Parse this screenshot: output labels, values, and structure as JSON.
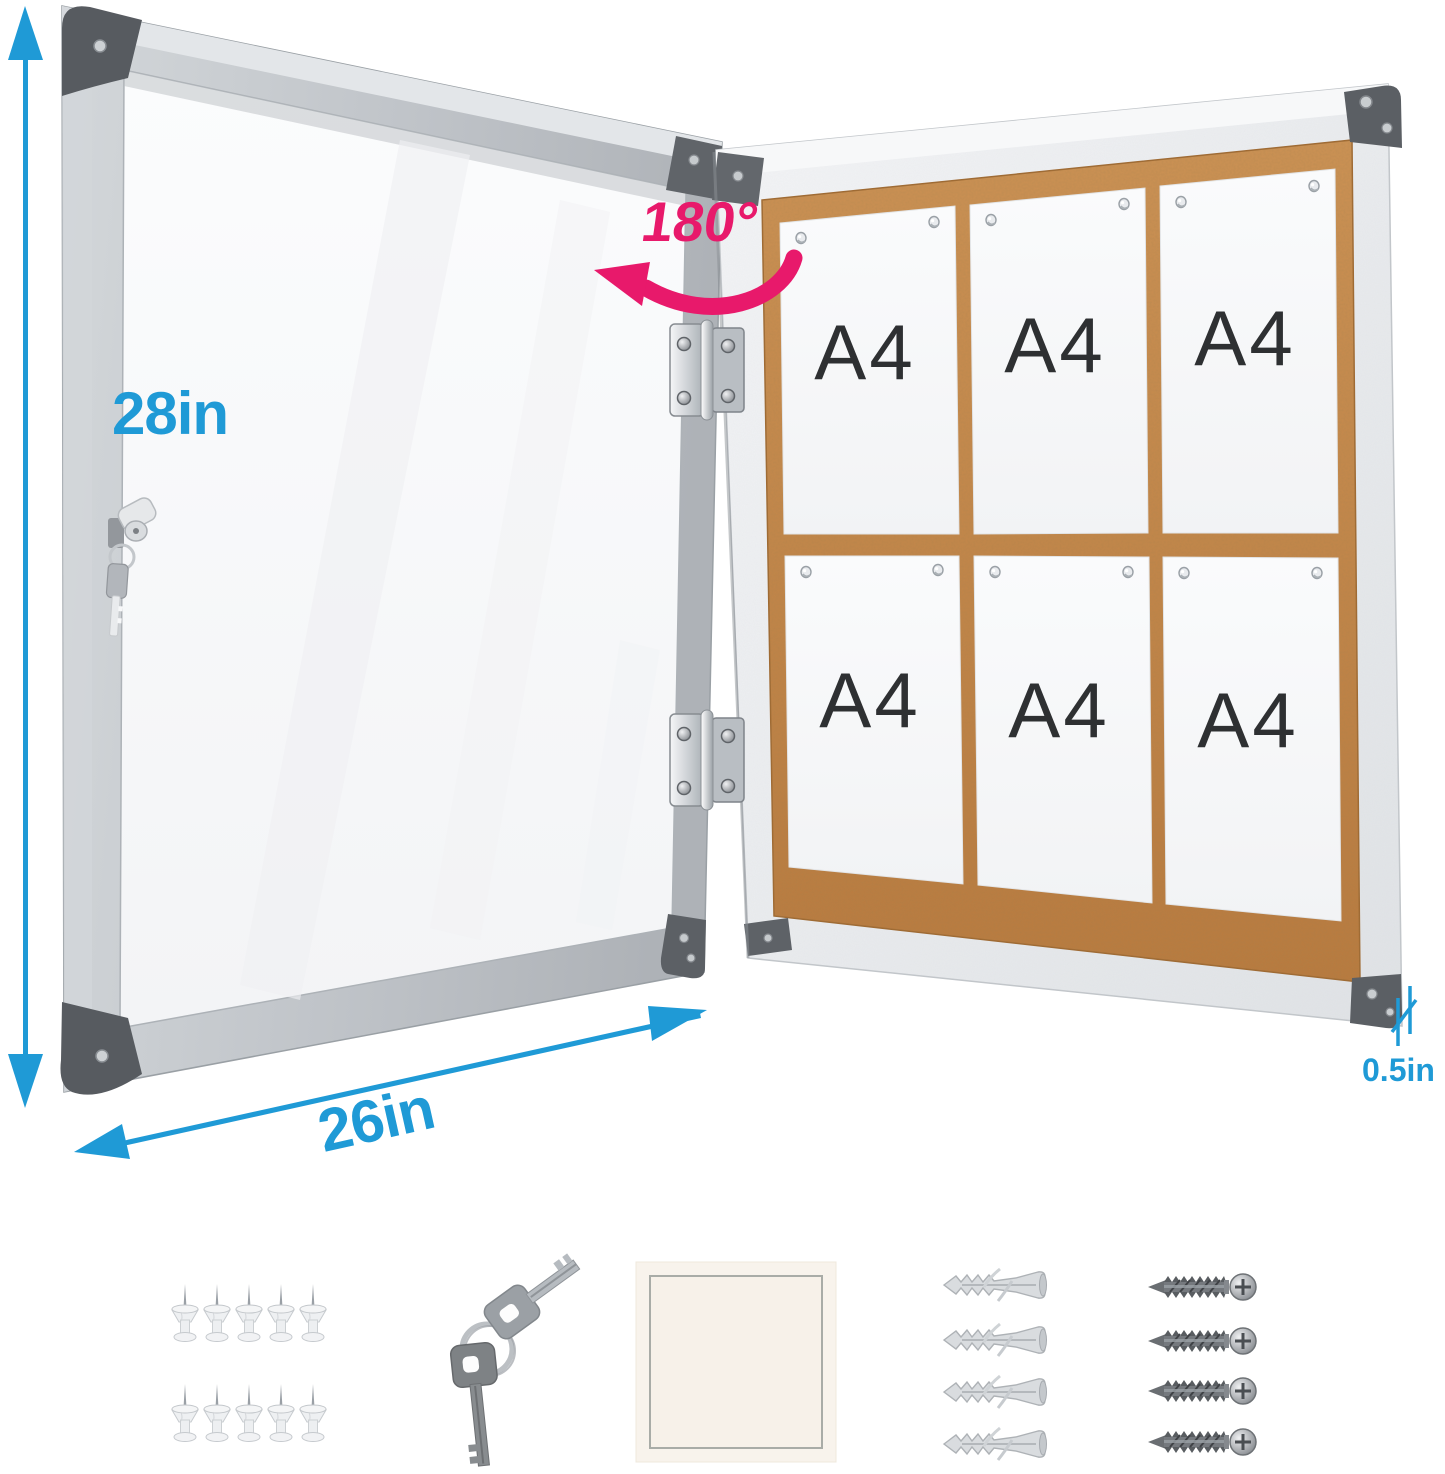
{
  "annotations": {
    "height": "28in",
    "width": "26in",
    "depth": "0.5in",
    "door_opening_angle": "180°"
  },
  "board": {
    "papers": [
      {
        "label": "A4"
      },
      {
        "label": "A4"
      },
      {
        "label": "A4"
      },
      {
        "label": "A4"
      },
      {
        "label": "A4"
      },
      {
        "label": "A4"
      }
    ],
    "pins_per_paper": 2,
    "surface": "cork"
  },
  "door": {
    "lock_icon": "cam-lock-with-hanging-key-icon",
    "hinge_count": 2
  },
  "accessories": {
    "push_pins": {
      "icon": "push-pin-icon",
      "count": 10
    },
    "keys": {
      "icon": "key-icon",
      "count": 2
    },
    "adhesive_pad": {
      "icon": "adhesive-pad-icon",
      "count": 1
    },
    "wall_anchors": {
      "icon": "wall-anchor-icon",
      "count": 4
    },
    "screws": {
      "icon": "screw-icon",
      "count": 4
    }
  },
  "colors": {
    "dimension_label": "#1F9AD6",
    "angle_label": "#E8196B",
    "cork": "#C0813F",
    "frame_silver": "#C8CCD0",
    "board_frame": "#ECEEF0",
    "corner_dark": "#5B5F64",
    "paper": "#F7F8FA",
    "a4_text": "#2E3032"
  }
}
